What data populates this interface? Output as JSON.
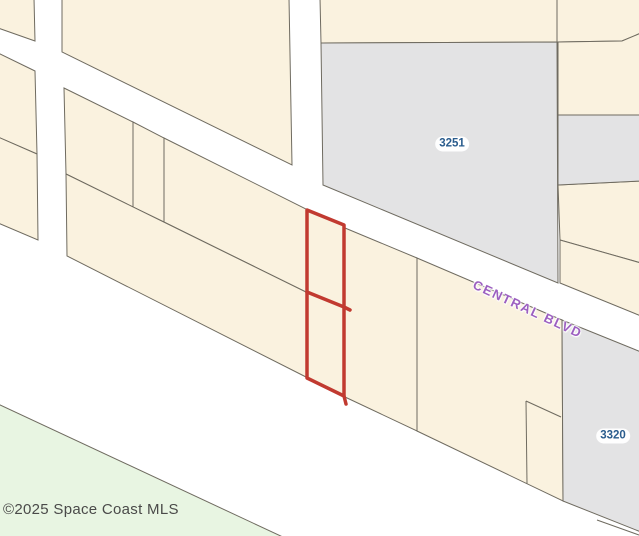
{
  "canvas": {
    "width": 639,
    "height": 536
  },
  "colors": {
    "background": "#ffffff",
    "cream": "#faf2df",
    "gray": "#e3e3e4",
    "green": "#e8f5e2",
    "line": "#6f6b60",
    "highlight_red": "#c13a30",
    "label_blue": "#2a5c8d",
    "road_purple": "#9c5fc0",
    "copyright_gray": "#4a4a49"
  },
  "map": {
    "polygons": [
      {
        "name": "lot-top-left",
        "fill": "cream",
        "points": "-2,-2 34,-2 35,41 -2,28"
      },
      {
        "name": "lot-left-upper",
        "fill": "cream",
        "points": "-2,53 35,71 37,154 -2,137"
      },
      {
        "name": "lot-left-lower",
        "fill": "cream",
        "points": "-2,137 37,154 38,240 -2,223"
      },
      {
        "name": "lot-top-middle",
        "fill": "cream",
        "points": "62,-2 289,-2 292,165 62,52"
      },
      {
        "name": "lot-top-center-right",
        "fill": "cream",
        "points": "320,-2 557,-2 557,42 321,43"
      },
      {
        "name": "lot-top-right",
        "fill": "cream",
        "points": "557,-2 641,-2 641,33 622,41 557,42"
      },
      {
        "name": "lot-right-row2",
        "fill": "cream",
        "points": "558,42 622,41 641,33 641,115 558,115"
      },
      {
        "name": "lot-right-row4",
        "fill": "cream",
        "points": "558,185 641,181 641,263 560,240"
      },
      {
        "name": "lot-right-sliver",
        "fill": "cream",
        "points": "560,240 641,263 641,316 560,283"
      },
      {
        "name": "parcel-3251",
        "fill": "gray",
        "points": "321,43 557,42 558,283 323,185"
      },
      {
        "name": "lot-right-gray-strip",
        "fill": "gray",
        "points": "558,115 641,115 641,181 558,185"
      },
      {
        "name": "belt-upper-1",
        "fill": "cream",
        "points": "64,88 133,122 133,207 66,174"
      },
      {
        "name": "belt-upper-2",
        "fill": "cream",
        "points": "133,122 164,138 164,222 133,207"
      },
      {
        "name": "belt-upper-3",
        "fill": "cream",
        "points": "164,138 308,210 308,293 164,222"
      },
      {
        "name": "belt-lower-long",
        "fill": "cream",
        "points": "66,174 308,293 308,378 67,256"
      },
      {
        "name": "belt-east-of-subject",
        "fill": "cream",
        "points": "345,228 417,258 417,431 345,397"
      },
      {
        "name": "belt-east-2",
        "fill": "cream",
        "points": "417,258 562,320 563,501 417,431"
      },
      {
        "name": "subject-cell-upper",
        "fill": "cream",
        "stroke": false,
        "points": "307,210 344,225 344,307 307,292"
      },
      {
        "name": "subject-cell-lower",
        "fill": "cream",
        "stroke": false,
        "points": "307,292 344,307 344,396 307,378"
      },
      {
        "name": "parcel-3320",
        "fill": "gray",
        "points": "562,320 641,352 641,532 563,501"
      },
      {
        "name": "green-area",
        "fill": "green",
        "points": "-2,404 285,538 -2,538"
      }
    ],
    "lines": [
      {
        "name": "small-lot-top-edge",
        "x1": 526,
        "y1": 401,
        "x2": 561,
        "y2": 417
      },
      {
        "name": "small-lot-left-edge",
        "x1": 526,
        "y1": 401,
        "x2": 527,
        "y2": 484
      },
      {
        "name": "corner-boundary",
        "x1": 597,
        "y1": 520,
        "x2": 639,
        "y2": 535
      }
    ],
    "highlight": {
      "name": "subject-parcel-outline",
      "outline": "M307,210 L344,225 L344,396 L307,378 Z",
      "divider": "M307,292 L344,307 L350,310",
      "tail": "M344,396 L346,404",
      "stroke_width": 3.5
    }
  },
  "labels": {
    "parcels": [
      {
        "text": "3251",
        "cx": 452,
        "cy": 144
      },
      {
        "text": "3320",
        "cx": 613,
        "cy": 436
      }
    ],
    "road": {
      "text": "CENTRAL BLVD",
      "x": 477,
      "y": 277,
      "rotation": 25
    },
    "copyright": {
      "text": "©2025 Space Coast MLS",
      "x": 3,
      "y": 501
    }
  }
}
